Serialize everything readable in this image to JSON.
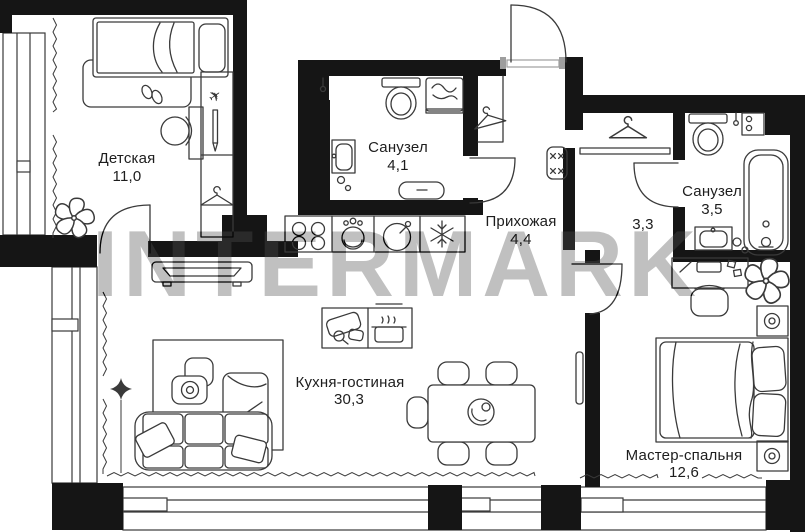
{
  "watermark": "INTERMARK",
  "plan": {
    "colors": {
      "wall": "#151515",
      "line": "#3a3a3a",
      "label": "#1d1d1d",
      "watermark": "#3f3f3f",
      "jamb": "#9e9e9e"
    },
    "rooms": [
      {
        "id": "detskaya",
        "name": "Детская",
        "area": "11,0"
      },
      {
        "id": "sanuzel-1",
        "name": "Санузел",
        "area": "4,1"
      },
      {
        "id": "prihozhaya",
        "name": "Прихожая",
        "area": "4,4"
      },
      {
        "id": "garderobnaya",
        "name": "",
        "area": "3,3"
      },
      {
        "id": "sanuzel-2",
        "name": "Санузел",
        "area": "3,5"
      },
      {
        "id": "kuhnya-gostinaya",
        "name": "Кухня-гостиная",
        "area": "30,3"
      },
      {
        "id": "master-spalnya",
        "name": "Мастер-спальня",
        "area": "12,6"
      }
    ],
    "icons": [
      "single-bed",
      "rug",
      "slippers",
      "desk",
      "desk-chair",
      "wardrobe",
      "toy-plane",
      "pencil",
      "hanger",
      "plant",
      "door-arc",
      "toilet",
      "washing-machine",
      "bathroom-sink",
      "vanity",
      "entrance-door",
      "coat-closet",
      "ottoman",
      "bathtub",
      "water-heater",
      "stove",
      "dishwasher",
      "kitchen-sink",
      "fridge-snowflake",
      "island-utensils",
      "dining-table",
      "dining-chair",
      "sofa",
      "armchair",
      "pouf",
      "chaise",
      "tv-console",
      "floor-lamp-sparkle",
      "radiator",
      "double-bed",
      "pillow",
      "nightstand-speaker",
      "work-desk",
      "window",
      "curtain-zigzag"
    ]
  }
}
